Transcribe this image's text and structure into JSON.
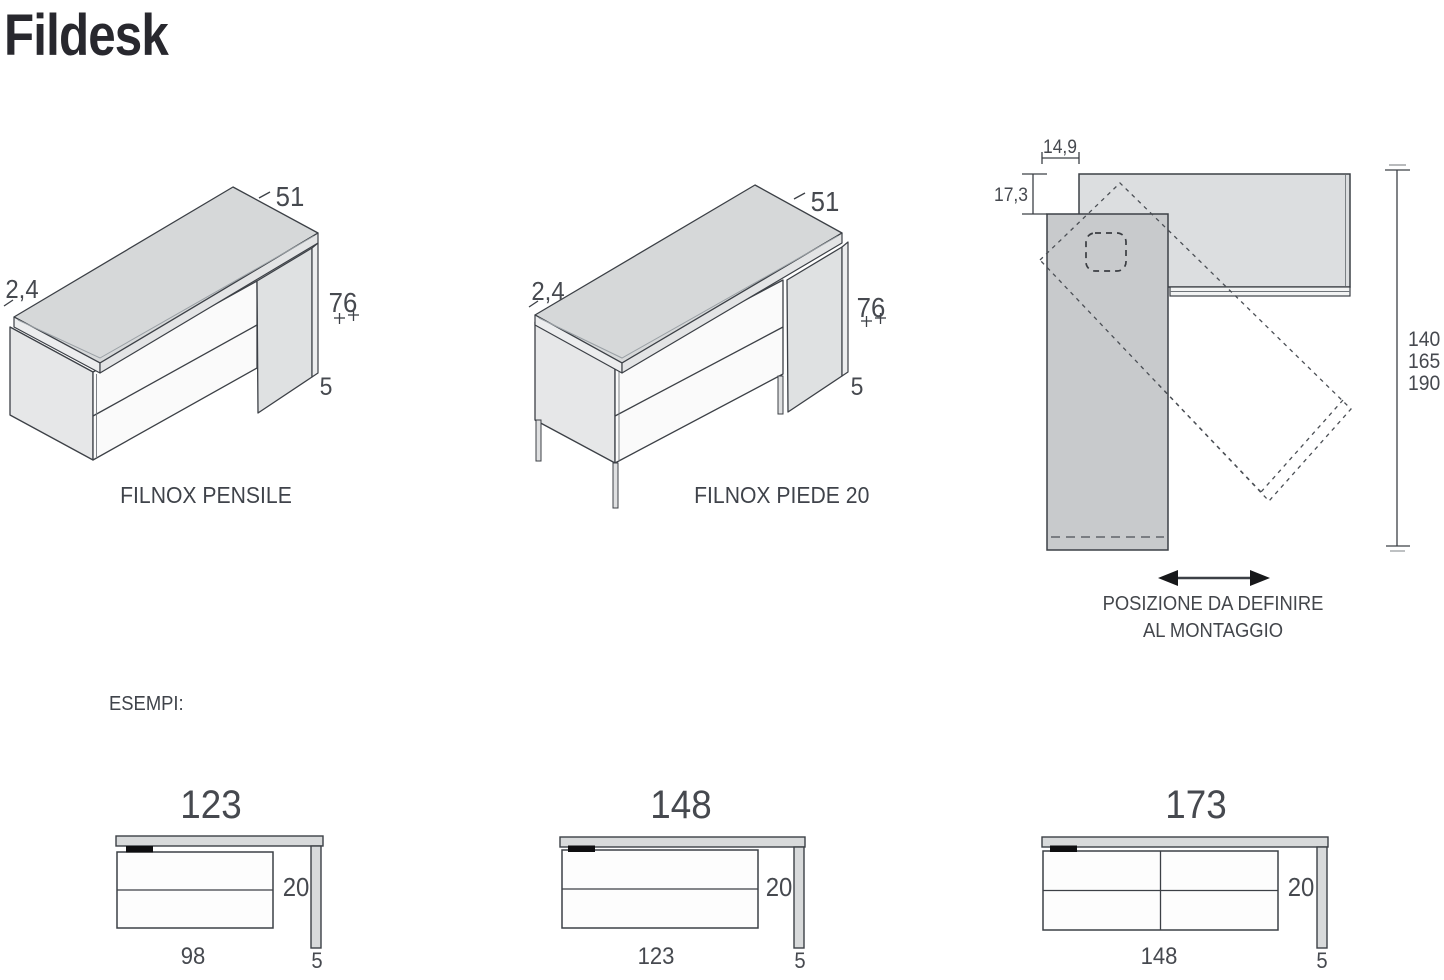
{
  "title": "Fildesk",
  "views": {
    "pensile": {
      "label": "FILNOX PENSILE",
      "depth": "51",
      "top_thickness": "2,4",
      "height": "76",
      "side_panel": "5"
    },
    "piede": {
      "label": "FILNOX PIEDE 20",
      "depth": "51",
      "top_thickness": "2,4",
      "height": "76",
      "side_panel": "5"
    },
    "top_view": {
      "offset_width": "14,9",
      "offset_depth": "17,3",
      "lengths": [
        "140",
        "165",
        "190"
      ],
      "note_line1": "POSIZIONE DA DEFINIRE",
      "note_line2": "AL MONTAGGIO"
    }
  },
  "examples": {
    "heading": "ESEMPI:",
    "items": [
      {
        "total": "123",
        "cabinet": "98",
        "gap": "20",
        "panel": "5"
      },
      {
        "total": "148",
        "cabinet": "123",
        "gap": "20",
        "panel": "5"
      },
      {
        "total": "173",
        "cabinet": "148",
        "gap": "20",
        "panel": "5"
      }
    ]
  },
  "colors": {
    "line": "#3c4046",
    "top_face": "#d6d8d9",
    "front_face": "#fafafa",
    "side_face": "#e6e7e8",
    "panel_face": "#dfe1e2",
    "plan_desktop": "#dcdee0",
    "plan_panel": "#c8cacc",
    "handle": "#0e0e10",
    "text": "#46494f"
  }
}
